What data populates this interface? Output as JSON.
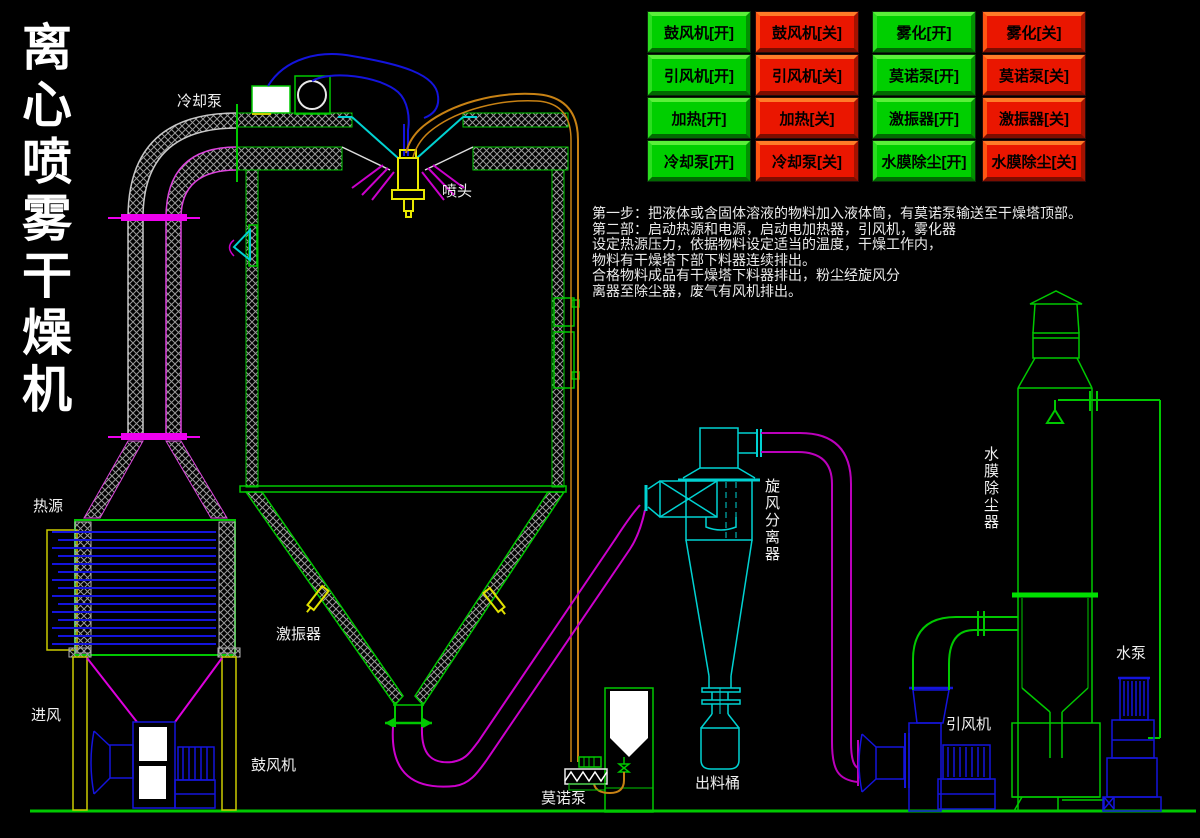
{
  "title": {
    "vertical_text": "离心喷雾干燥机",
    "chars": [
      "离",
      "心",
      "喷",
      "雾",
      "干",
      "燥",
      "机"
    ]
  },
  "control_panel": {
    "buttons": [
      {
        "label": "鼓风机[开]",
        "device": "blower",
        "state": "on"
      },
      {
        "label": "鼓风机[关]",
        "device": "blower",
        "state": "off"
      },
      {
        "label": "雾化[开]",
        "device": "atomizer",
        "state": "on"
      },
      {
        "label": "雾化[关]",
        "device": "atomizer",
        "state": "off"
      },
      {
        "label": "引风机[开]",
        "device": "induced-fan",
        "state": "on"
      },
      {
        "label": "引风机[关]",
        "device": "induced-fan",
        "state": "off"
      },
      {
        "label": "莫诺泵[开]",
        "device": "mono-pump",
        "state": "on"
      },
      {
        "label": "莫诺泵[关]",
        "device": "mono-pump",
        "state": "off"
      },
      {
        "label": "加热[开]",
        "device": "heater",
        "state": "on"
      },
      {
        "label": "加热[关]",
        "device": "heater",
        "state": "off"
      },
      {
        "label": "激振器[开]",
        "device": "vibrator",
        "state": "on"
      },
      {
        "label": "激振器[关]",
        "device": "vibrator",
        "state": "off"
      },
      {
        "label": "冷却泵[开]",
        "device": "cooling-pump",
        "state": "on"
      },
      {
        "label": "冷却泵[关]",
        "device": "cooling-pump",
        "state": "off"
      },
      {
        "label": "水膜除尘[开]",
        "device": "water-film",
        "state": "on"
      },
      {
        "label": "水膜除尘[关]",
        "device": "water-film",
        "state": "off"
      }
    ]
  },
  "instructions": {
    "lines": [
      "第一步：把液体或含固体溶液的物料加入液体筒，有莫诺泵输送至干燥塔顶部。",
      "第二部：启动热源和电源，启动电加热器，引风机，雾化器",
      "设定热源压力，依据物料设定适当的温度，干燥工作内，",
      "物料有干燥塔下部下料器连续排出。",
      "合格物料成品有干燥塔下料器排出，粉尘经旋风分",
      "离器至除尘器，废气有风机排出。"
    ]
  },
  "diagram": {
    "labels": {
      "cooling_pump": "冷却泵",
      "spray_head": "喷头",
      "heat_source": "热源",
      "air_inlet": "进风",
      "blower": "鼓风机",
      "vibrator": "激振器",
      "mono_pump": "莫诺泵",
      "discharge_barrel": "出料桶",
      "cyclone": "旋风分离器",
      "induced_fan": "引风机",
      "scrubber": "水膜除尘器",
      "water_pump": "水泵"
    }
  },
  "colors": {
    "background": "#000000",
    "cad_green": "#00c800",
    "cad_cyan": "#00d2d2",
    "cad_magenta": "#cc00cc",
    "flange_magenta": "#ee00ee",
    "cad_blue": "#1414dc",
    "cad_orange": "#c88214",
    "cad_yellow": "#e0e000",
    "hatch_gray": "#9a9a9a",
    "button_green": "#00cf00",
    "button_red": "#ea1600",
    "text_white": "#f0f0f0"
  }
}
